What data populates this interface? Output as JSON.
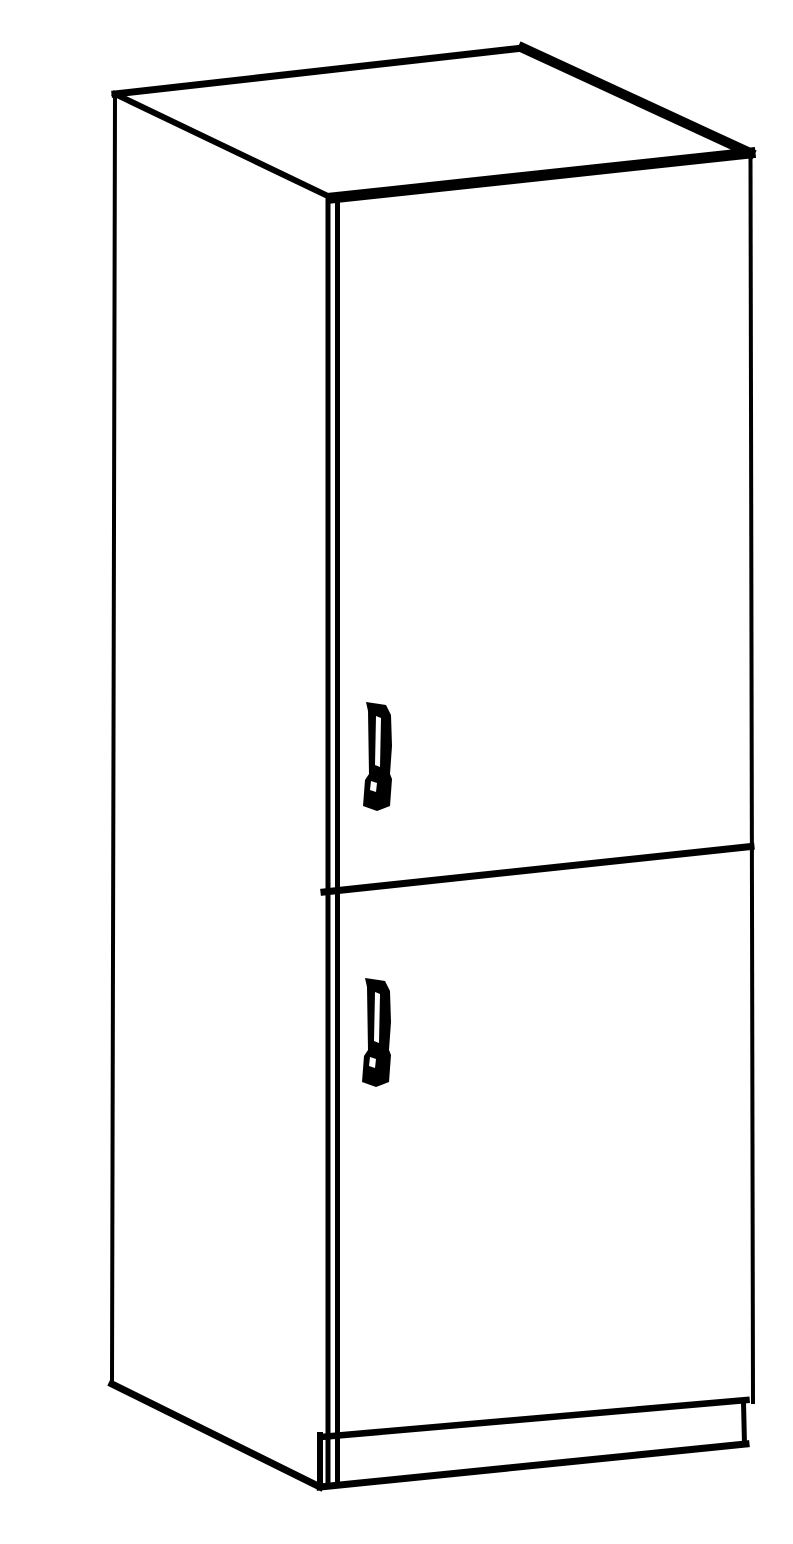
{
  "illustration": {
    "subject": "Tall free-standing two-door cabinet, product line-art drawing",
    "view": "three-quarter perspective from front-left",
    "style": "black outline line art on white background, no shading, no text",
    "parts": [
      "top-panel",
      "left-side-panel",
      "upper-door",
      "lower-door",
      "door-divider",
      "upper-door-handle",
      "lower-door-handle",
      "plinth-base"
    ]
  },
  "colors": {
    "background": "#ffffff",
    "line": "#000000",
    "handle_fill": "#000000",
    "surface": "#ffffff"
  }
}
